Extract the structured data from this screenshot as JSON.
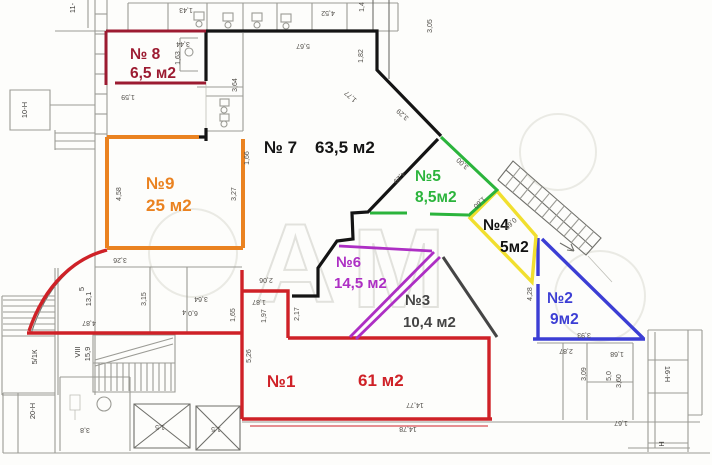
{
  "title": "Поэтажный план помещений",
  "watermark": {
    "letters": [
      "А",
      "М"
    ]
  },
  "rooms": [
    {
      "id": "1",
      "label": "№1",
      "area": "61 м2",
      "color": "#cf2127"
    },
    {
      "id": "2",
      "label": "№2",
      "area": "9м2",
      "color": "#3c3ed4"
    },
    {
      "id": "3",
      "label": "№3",
      "area": "10,4 м2",
      "color": "#454545"
    },
    {
      "id": "4",
      "label": "№4",
      "area": "5м2",
      "color": "#111111",
      "outline": "#f1df2f"
    },
    {
      "id": "5",
      "label": "№5",
      "area": "8,5м2",
      "color": "#2bb43c"
    },
    {
      "id": "6",
      "label": "№6",
      "area": "14,5 м2",
      "color": "#ad2fc4"
    },
    {
      "id": "7",
      "label": "№ 7",
      "area": "63,5 м2",
      "color": "#141414"
    },
    {
      "id": "8",
      "label": "№ 8",
      "area": "6,5 м2",
      "color": "#9c1b31"
    },
    {
      "id": "9",
      "label": "№9",
      "area": "25 м2",
      "color": "#ea8220"
    }
  ],
  "plan_texts": [
    {
      "id": "t1",
      "text": "5,67"
    },
    {
      "id": "t2",
      "text": "1,82"
    },
    {
      "id": "t3",
      "text": "1,77"
    },
    {
      "id": "t4",
      "text": "3,29"
    },
    {
      "id": "t5",
      "text": "4,29"
    },
    {
      "id": "t6",
      "text": "3,00"
    },
    {
      "id": "t7",
      "text": "1,60"
    },
    {
      "id": "t8",
      "text": "0,69"
    },
    {
      "id": "t9",
      "text": "1,66"
    },
    {
      "id": "t10",
      "text": "2,06"
    },
    {
      "id": "t11",
      "text": "1,87"
    },
    {
      "id": "t12",
      "text": "1,97"
    },
    {
      "id": "t13",
      "text": "2,17"
    },
    {
      "id": "t14",
      "text": "5,26"
    },
    {
      "id": "t15",
      "text": "1,65"
    },
    {
      "id": "t16",
      "text": "3,15"
    },
    {
      "id": "t17",
      "text": "3,64"
    },
    {
      "id": "t18",
      "text": "6,0"
    },
    {
      "id": "t19",
      "text": "4"
    },
    {
      "id": "t20",
      "text": "4,87"
    },
    {
      "id": "t21",
      "text": "13,1"
    },
    {
      "id": "t22",
      "text": "5"
    },
    {
      "id": "t23",
      "text": "VIII"
    },
    {
      "id": "t24",
      "text": "15,9"
    },
    {
      "id": "t25",
      "text": "5/1К"
    },
    {
      "id": "t26",
      "text": "20-Н"
    },
    {
      "id": "t27",
      "text": "10-Н"
    },
    {
      "id": "t28",
      "text": "11-"
    },
    {
      "id": "t29",
      "text": "3,8"
    },
    {
      "id": "t30",
      "text": "1,5"
    },
    {
      "id": "t31",
      "text": "1,5"
    },
    {
      "id": "t32",
      "text": "14,77"
    },
    {
      "id": "t33",
      "text": "14,78"
    },
    {
      "id": "t34",
      "text": "3,93"
    },
    {
      "id": "t35",
      "text": "2,87"
    },
    {
      "id": "t36",
      "text": "1,68"
    },
    {
      "id": "t37",
      "text": "3,09"
    },
    {
      "id": "t38",
      "text": "3,60"
    },
    {
      "id": "t39",
      "text": "5,0"
    },
    {
      "id": "t40",
      "text": "1,67"
    },
    {
      "id": "t41",
      "text": "16-Н"
    },
    {
      "id": "t42",
      "text": "Н"
    },
    {
      "id": "t43",
      "text": "4,28"
    },
    {
      "id": "t44",
      "text": "4,58"
    },
    {
      "id": "t45",
      "text": "3,27"
    },
    {
      "id": "t46",
      "text": "3,26"
    },
    {
      "id": "t47",
      "text": "1,43"
    },
    {
      "id": "t48",
      "text": "4,52"
    },
    {
      "id": "t49",
      "text": "1,4"
    },
    {
      "id": "t50",
      "text": "3,44"
    },
    {
      "id": "t51",
      "text": "1,63"
    },
    {
      "id": "t52",
      "text": "3,64"
    },
    {
      "id": "t53",
      "text": "1,59"
    },
    {
      "id": "t54",
      "text": "3,05"
    }
  ]
}
